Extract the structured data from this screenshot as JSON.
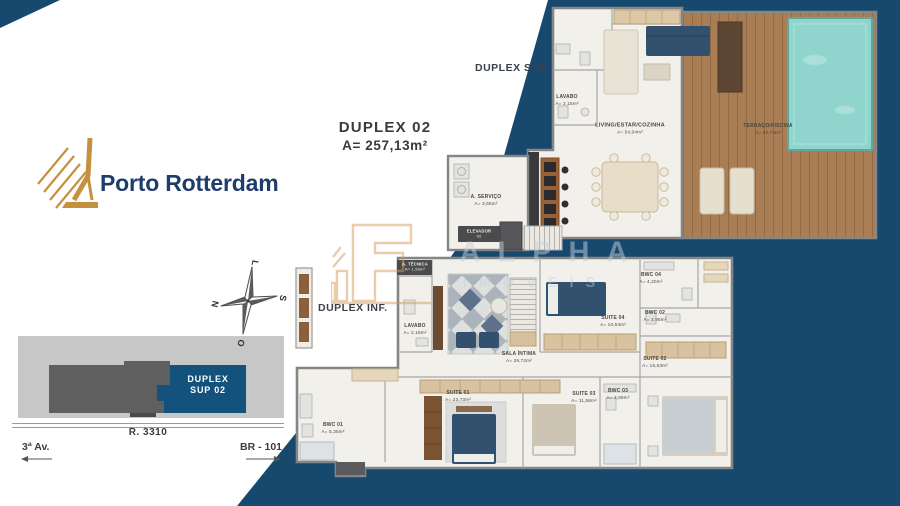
{
  "brand": {
    "name": "Porto Rotterdam"
  },
  "unit": {
    "title": "DUPLEX 02",
    "area": "A= 257,13m²"
  },
  "floor_tags": {
    "sup": "DUPLEX SUP.",
    "inf": "DUPLEX INF."
  },
  "compass": {
    "top": "L",
    "right": "S",
    "left": "N",
    "bottom": "O"
  },
  "site_map": {
    "unit_line1": "DUPLEX",
    "unit_line2": "SUP 02",
    "street": "R. 3310",
    "road_left": "3ª Av.",
    "road_right": "BR - 101"
  },
  "watermark": {
    "line1": "ALPHA",
    "line2": "IMÓVEIS"
  },
  "rooms": {
    "sup": [
      {
        "name": "LAVABO",
        "area": "A= 2,15m²"
      },
      {
        "name": "LIVING/ESTAR/COZINHA",
        "area": "A= 54,04m²"
      },
      {
        "name": "TERRAÇO/PISCINA",
        "area": "A= 52,74m²"
      },
      {
        "name": "A. SERVIÇO",
        "area": "A= 3,55m²"
      },
      {
        "name": "ELEVADOR",
        "area": "02"
      }
    ],
    "inf": [
      {
        "name": "A. TÉCNICA",
        "area": "A= 1,50m²"
      },
      {
        "name": "LAVABO",
        "area": "A= 2,19m²"
      },
      {
        "name": "SALA ÍNTIMA",
        "area": "A= 29,72m²"
      },
      {
        "name": "SUITE 04",
        "area": "A= 10,54m²"
      },
      {
        "name": "BWC 04",
        "area": "A= 4,20m²"
      },
      {
        "name": "BWC 02",
        "area": "A= 3,98m²"
      },
      {
        "name": "SUITE 02",
        "area": "A= 16,53m²"
      },
      {
        "name": "SUITE 01",
        "area": "A= 23,73m²"
      },
      {
        "name": "BWC 01",
        "area": "A= 5,35m²"
      },
      {
        "name": "SUITE 03",
        "area": "A= 11,58m²"
      },
      {
        "name": "BWC 03",
        "area": "A= 3,88m²"
      }
    ]
  },
  "colors": {
    "navy_background": "#17496F",
    "brand_gold": "#C6913F",
    "brand_navy": "#1E3C6C",
    "site_highlight_blue": "#14527E"
  }
}
